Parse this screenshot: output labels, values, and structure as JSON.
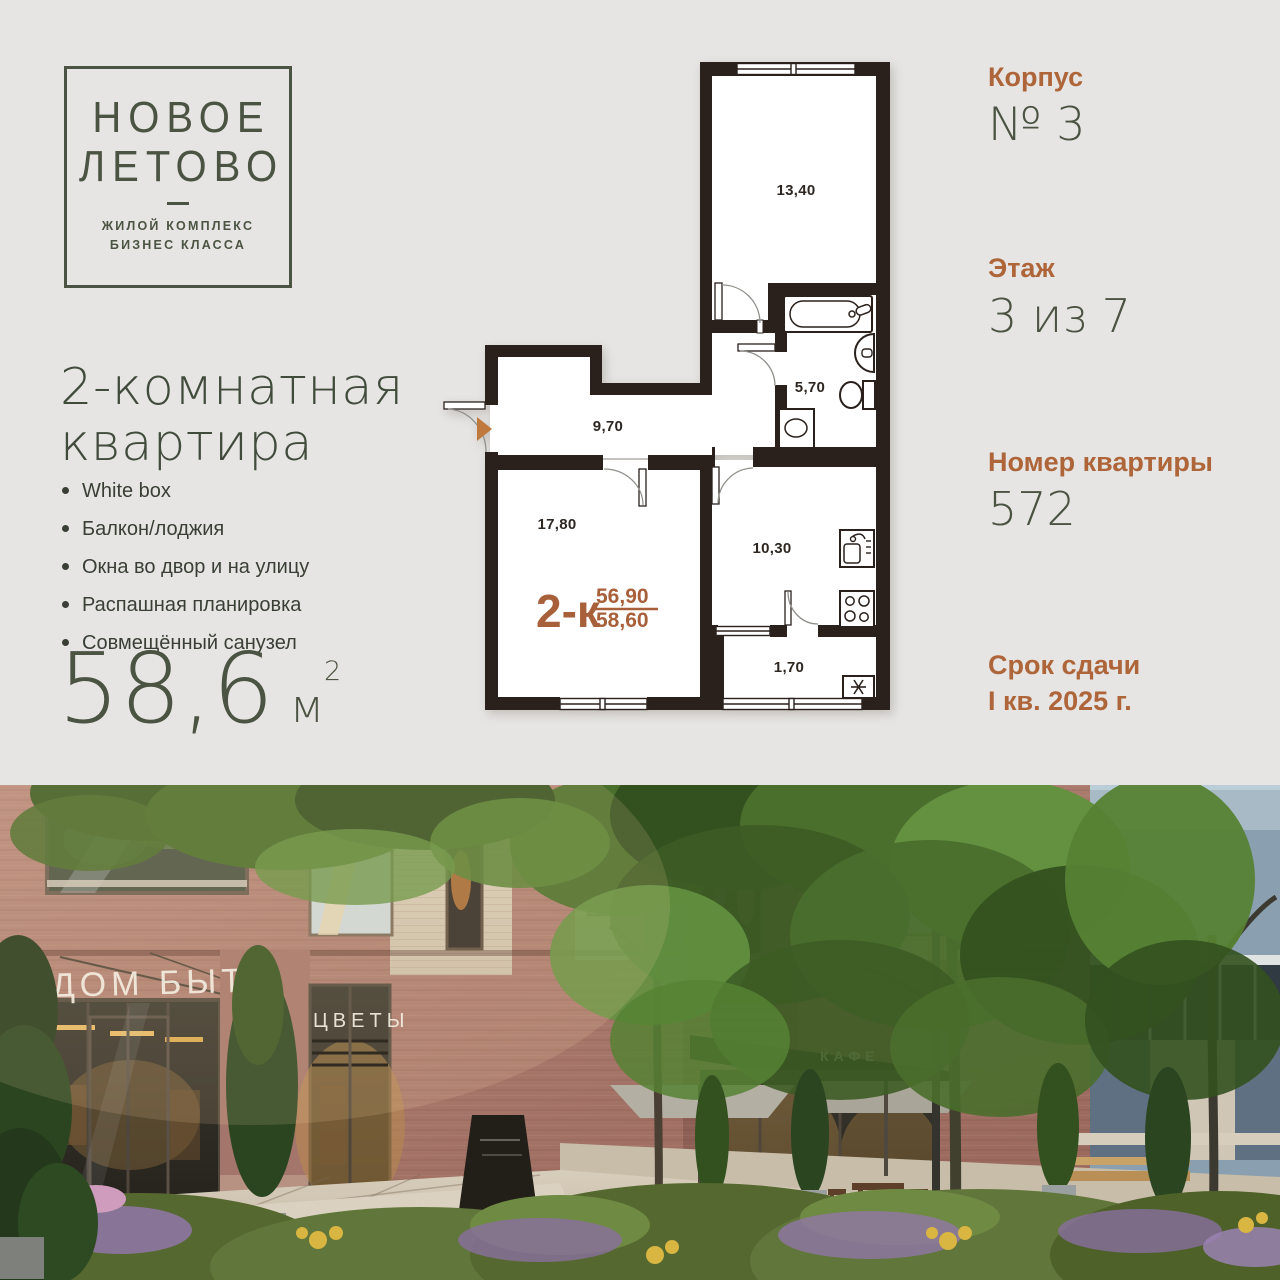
{
  "colors": {
    "background": "#e6e5e3",
    "brand_green": "#4b5442",
    "accent_orange": "#ae6539",
    "plan_walls": "#2a211c"
  },
  "logo": {
    "line1": "НОВОЕ",
    "line2": "ЛЕТОВО",
    "sub1": "ЖИЛОЙ КОМПЛЕКС",
    "sub2": "БИЗНЕС КЛАССА"
  },
  "listing": {
    "title1": "2-комнатная",
    "title2": "квартира",
    "features": [
      "White box",
      "Балкон/лоджия",
      "Окна во двор и на улицу",
      "Распашная планировка",
      "Совмещённый санузел"
    ],
    "area": {
      "value": "58,6",
      "unit": "м",
      "sup": "2"
    }
  },
  "details": {
    "building": {
      "label": "Корпус",
      "value": "№ 3"
    },
    "floor": {
      "label": "Этаж",
      "value": "3 из 7"
    },
    "apartment": {
      "label": "Номер квартиры",
      "value": "572"
    },
    "deadline": {
      "label": "Срок сдачи",
      "value": "I кв. 2025 г."
    }
  },
  "floorplan": {
    "type_label": "2-к",
    "area_living": "56,90",
    "area_total": "58,60",
    "rooms": {
      "bedroom": "13,40",
      "bathroom": "5,70",
      "hall": "9,70",
      "living": "17,80",
      "kitchen": "10,30",
      "balcony": "1,70"
    }
  },
  "photo": {
    "sign_dom_byta": "ДОМ БЫТА",
    "sign_cvety": "ЦВЕТЫ",
    "sign_cafe": "КАФЕ"
  }
}
